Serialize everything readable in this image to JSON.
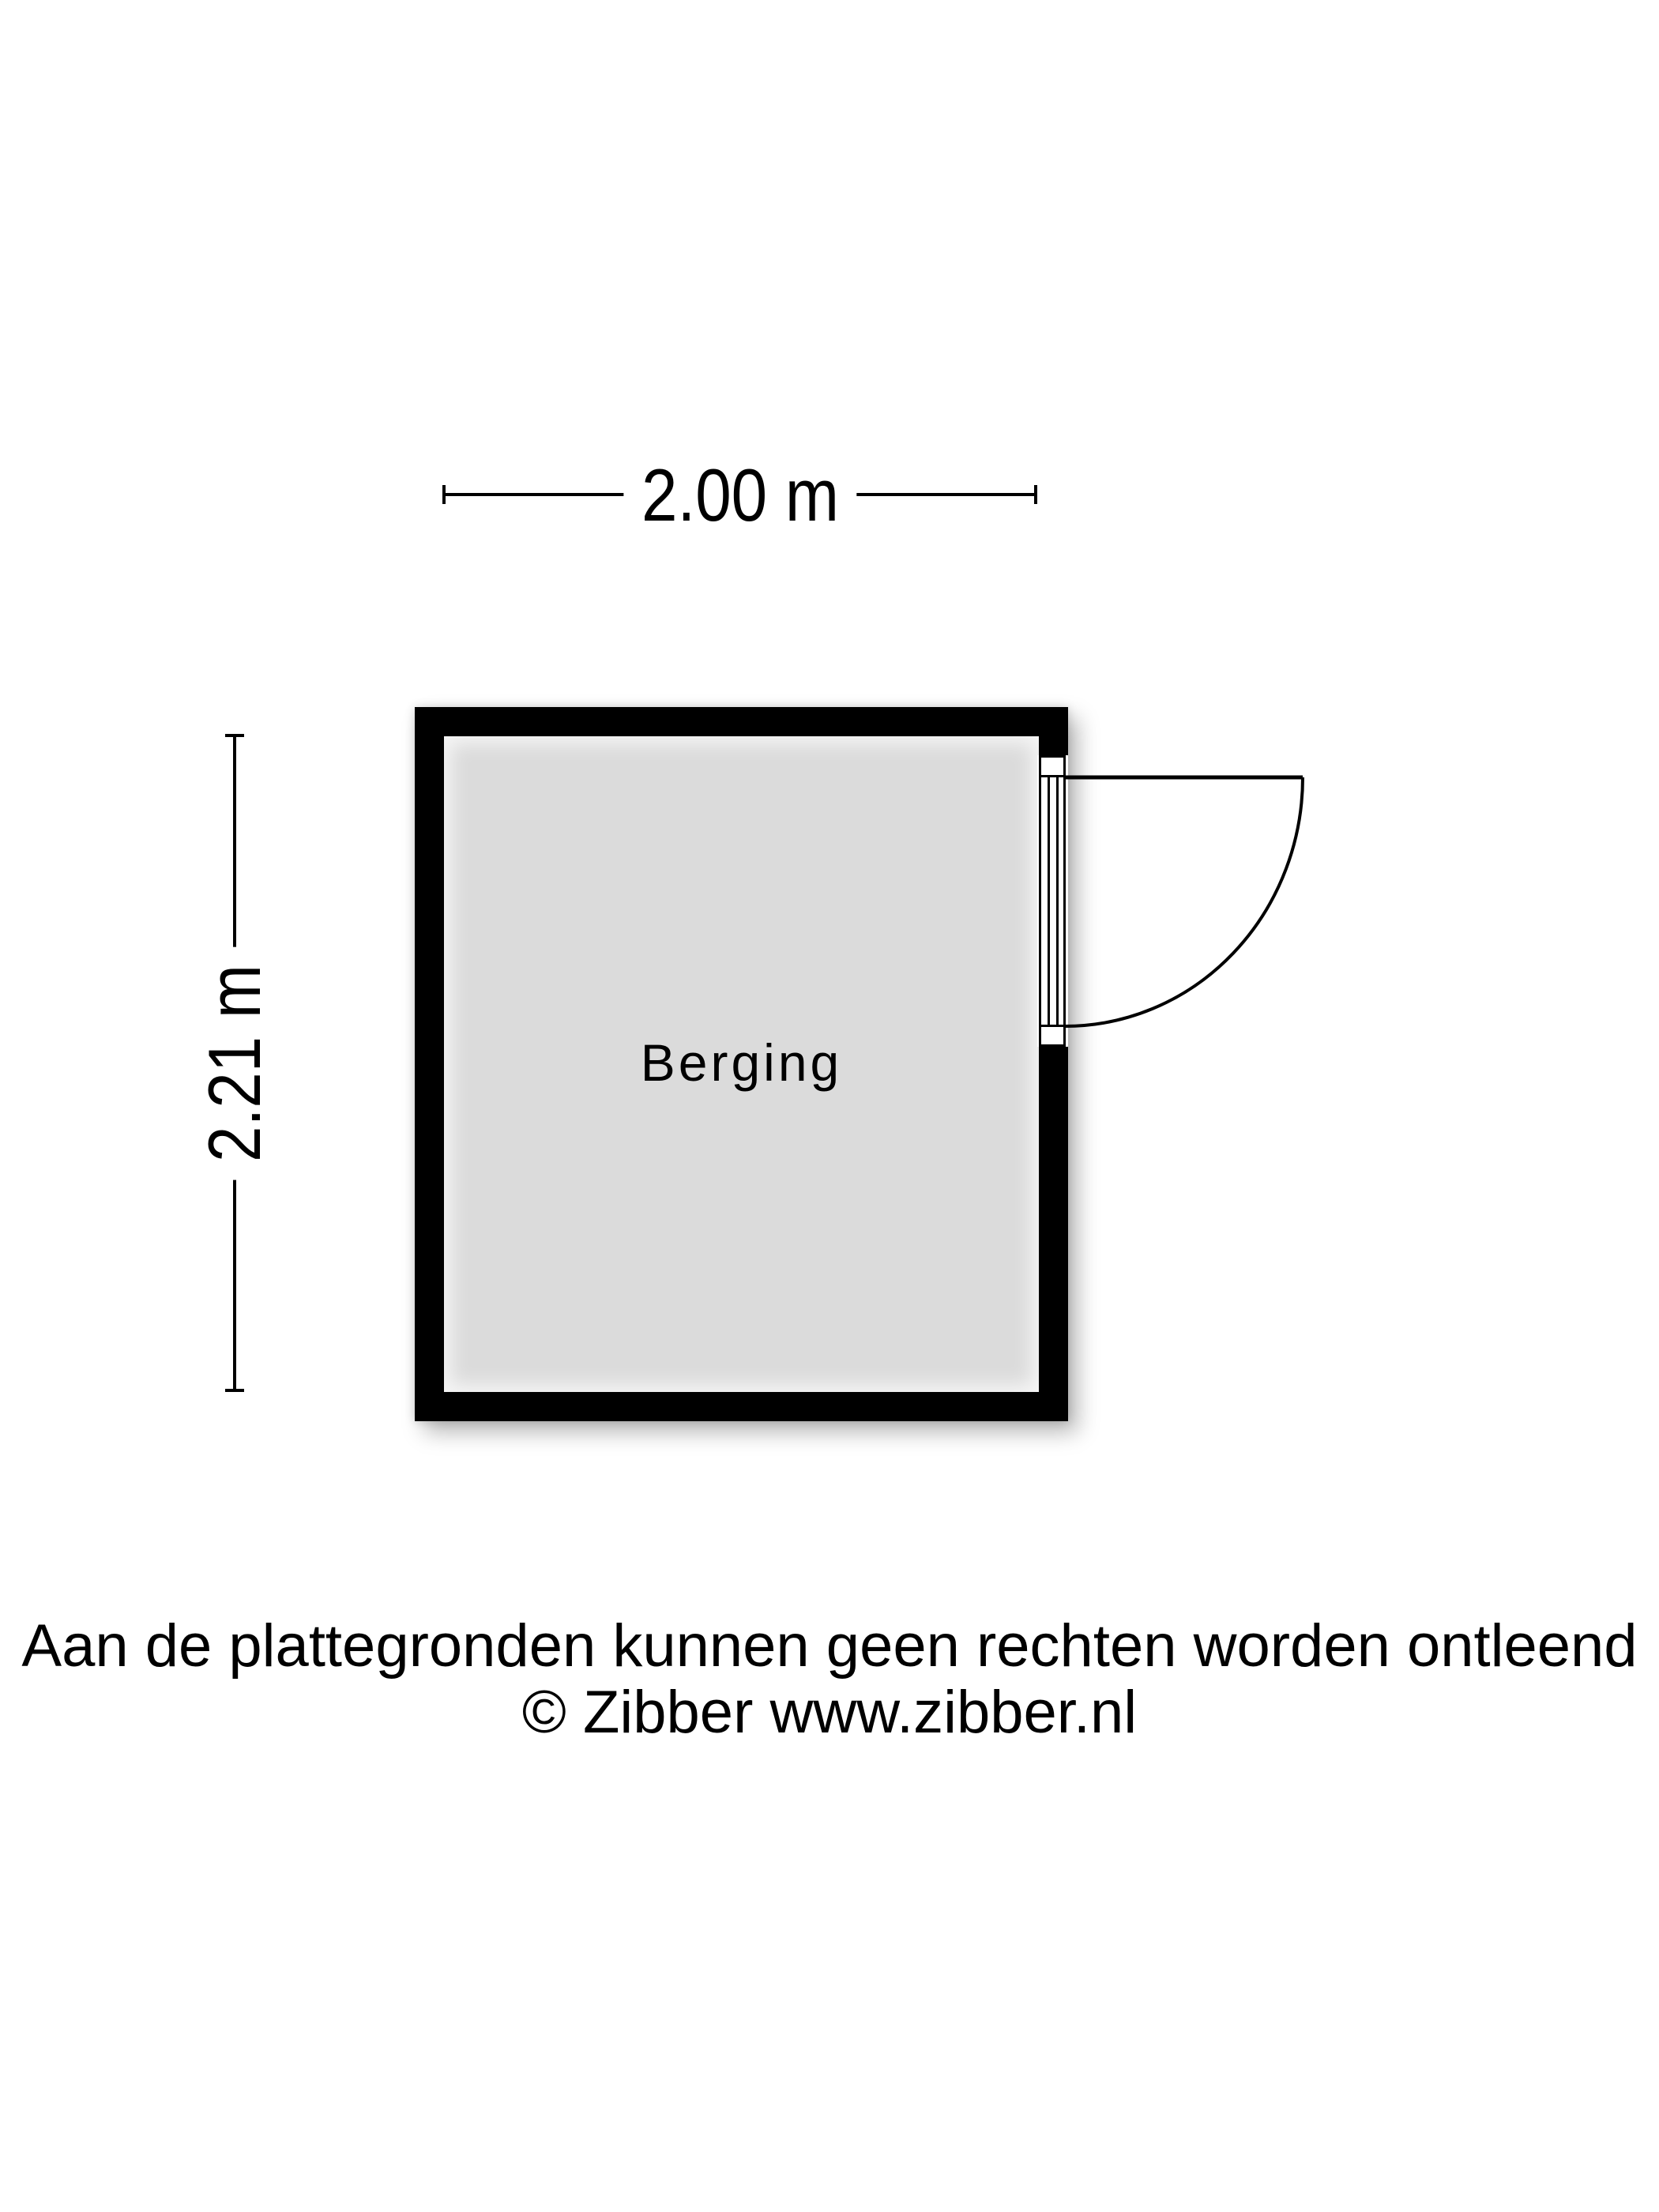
{
  "page": {
    "background_color": "#ffffff"
  },
  "floor_plan": {
    "room": {
      "label": "Berging"
    },
    "dimensions": {
      "width_label": "2.00 m",
      "height_label": "2.21 m"
    },
    "colors": {
      "wall": "#000000",
      "floor": "#dbdbdb",
      "line": "#000000"
    }
  },
  "footer": {
    "disclaimer": "Aan de plattegronden kunnen geen rechten worden ontleend",
    "copyright": "© Zibber www.zibber.nl"
  }
}
